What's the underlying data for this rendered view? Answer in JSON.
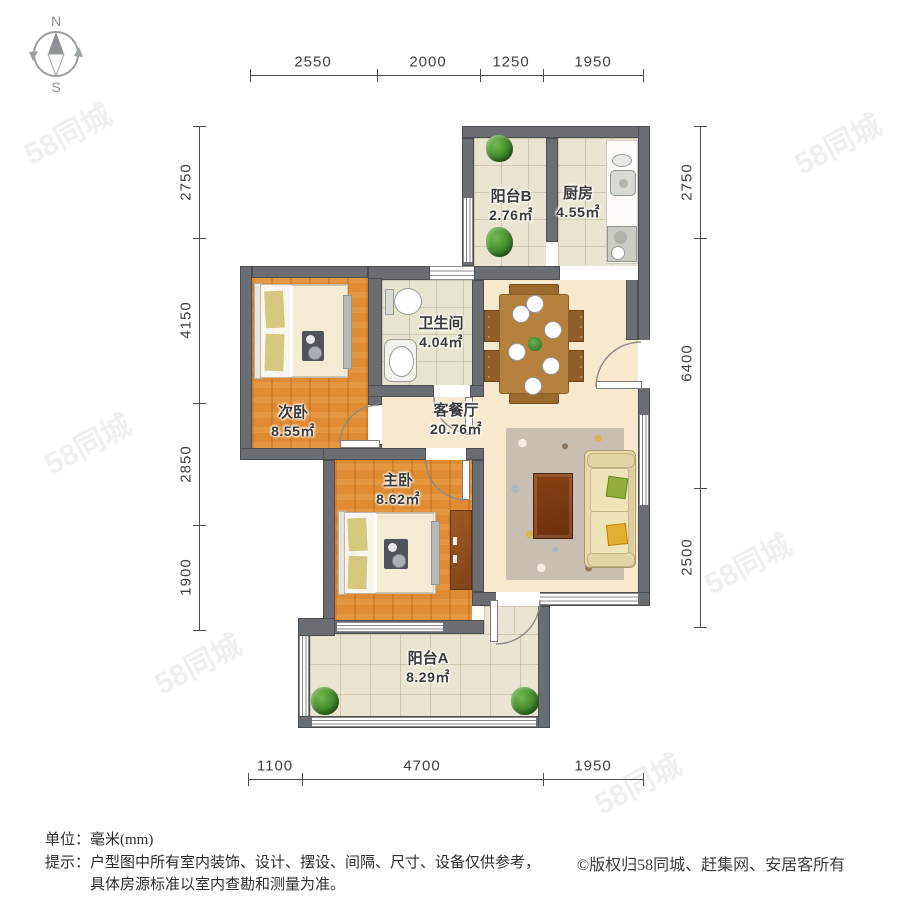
{
  "compass": {
    "north": "N",
    "south": "S"
  },
  "watermark": "58同城",
  "rooms": [
    {
      "id": "balcony-b",
      "name": "阳台B",
      "area": "2.76㎡"
    },
    {
      "id": "kitchen",
      "name": "厨房",
      "area": "4.55㎡"
    },
    {
      "id": "bathroom",
      "name": "卫生间",
      "area": "4.04㎡"
    },
    {
      "id": "bedroom-second",
      "name": "次卧",
      "area": "8.55㎡"
    },
    {
      "id": "living-dining",
      "name": "客餐厅",
      "area": "20.76㎡"
    },
    {
      "id": "bedroom-master",
      "name": "主卧",
      "area": "8.62㎡"
    },
    {
      "id": "balcony-a",
      "name": "阳台A",
      "area": "8.29㎡"
    }
  ],
  "dimensions": {
    "top": [
      "2550",
      "2000",
      "1250",
      "1950"
    ],
    "bottom": [
      "1100",
      "4700",
      "1950"
    ],
    "left": [
      "2750",
      "4150",
      "2850",
      "1900"
    ],
    "right": [
      "2750",
      "6400",
      "2500"
    ]
  },
  "footer": {
    "unit": "单位：毫米(mm)",
    "tip_prefix": "提示：",
    "tip_line1": "户型图中所有室内装饰、设计、摆设、间隔、尺寸、设备仅供参考，",
    "tip_line2": "具体房源标准以室内查勘和测量为准。",
    "copyright": "©版权归58同城、赶集网、安居客所有"
  }
}
